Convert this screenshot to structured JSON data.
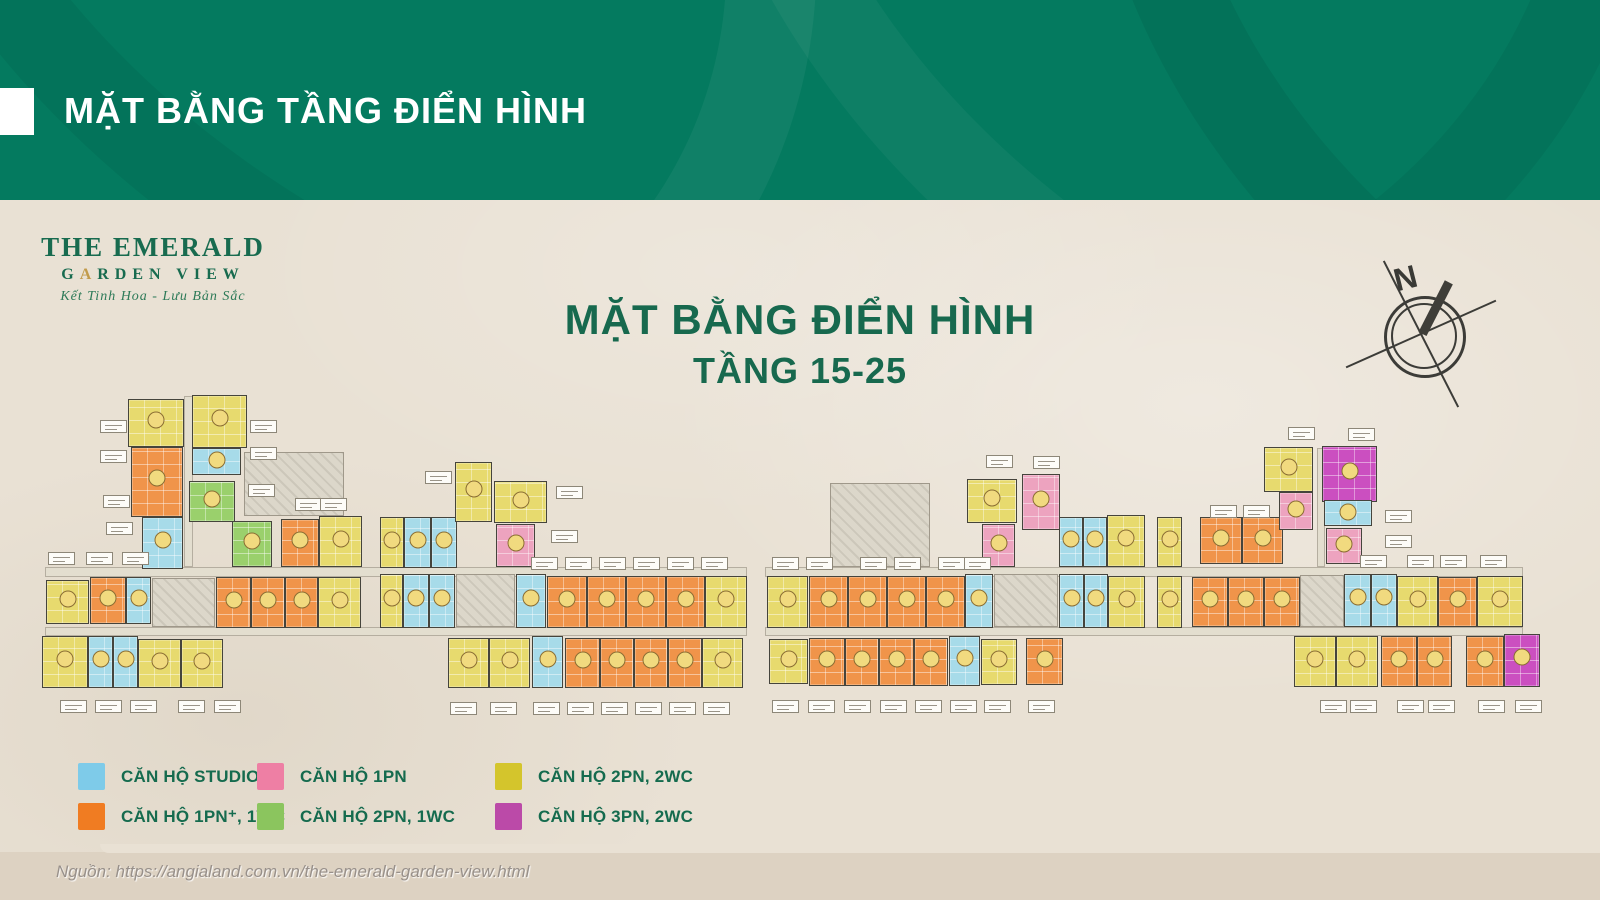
{
  "banner": {
    "title": "MẶT BẰNG TẦNG ĐIỂN HÌNH"
  },
  "logo": {
    "line1": "THE EMERALD",
    "garden_g": "G",
    "garden_a": "A",
    "garden_rest": "RDEN VIEW",
    "tagline": "Kết Tinh Hoa - Lưu Bản Sắc"
  },
  "heading": {
    "title": "MẶT BẰNG ĐIỂN HÌNH",
    "subtitle": "TẦNG 15-25"
  },
  "compass": {
    "label": "N"
  },
  "source": {
    "text": "Nguồn: https://angialand.com.vn/the-emerald-garden-view.html"
  },
  "legend": {
    "items": [
      {
        "type": "s",
        "label": "CĂN HỘ STUDIO"
      },
      {
        "type": "p",
        "label": "CĂN HỘ 1PN"
      },
      {
        "type": "y",
        "label": "CĂN HỘ 2PN, 2WC"
      },
      {
        "type": "o",
        "label": "CĂN HỘ 1PN⁺, 1WC"
      },
      {
        "type": "g",
        "label": "CĂN HỘ 2PN, 1WC"
      },
      {
        "type": "m",
        "label": "CĂN HỘ 3PN, 2WC"
      }
    ]
  },
  "colors": {
    "banner_green": "#047a5f",
    "title_green": "#17694e",
    "legend_swatches": {
      "s": "#7ecbe9",
      "p": "#ee7fa4",
      "y": "#d4c52c",
      "o": "#f07c22",
      "g": "#8bc55e",
      "m": "#bb4aa8"
    },
    "unit_types": {
      "s": "#a7dbe9",
      "p": "#eda3bf",
      "y": "#e7da6e",
      "o": "#f0944a",
      "g": "#9ad06c",
      "m": "#cb4fc0"
    },
    "type_names": {
      "s": "studio",
      "p": "1pn",
      "y": "2pn-2wc",
      "o": "1pn-plus-1wc",
      "g": "2pn-1wc",
      "m": "3pn-2wc"
    }
  },
  "floorplan": {
    "units": [
      [
        128,
        399,
        56,
        48,
        "y"
      ],
      [
        192,
        395,
        55,
        53,
        "y"
      ],
      [
        131,
        447,
        52,
        70,
        "o"
      ],
      [
        192,
        448,
        49,
        27,
        "s"
      ],
      [
        189,
        481,
        46,
        41,
        "g"
      ],
      [
        142,
        517,
        41,
        52,
        "s"
      ],
      [
        232,
        521,
        40,
        46,
        "g"
      ],
      [
        281,
        519,
        38,
        48,
        "o"
      ],
      [
        319,
        516,
        43,
        51,
        "y"
      ],
      [
        380,
        517,
        24,
        51,
        "y"
      ],
      [
        404,
        517,
        27,
        51,
        "s"
      ],
      [
        431,
        517,
        26,
        51,
        "s"
      ],
      [
        455,
        462,
        37,
        60,
        "y"
      ],
      [
        494,
        481,
        53,
        42,
        "y"
      ],
      [
        496,
        524,
        39,
        43,
        "p"
      ],
      [
        46,
        580,
        43,
        44,
        "y"
      ],
      [
        90,
        577,
        36,
        47,
        "o"
      ],
      [
        126,
        577,
        25,
        47,
        "s"
      ],
      [
        216,
        577,
        35,
        51,
        "o"
      ],
      [
        251,
        577,
        34,
        51,
        "o"
      ],
      [
        285,
        577,
        33,
        51,
        "o"
      ],
      [
        318,
        577,
        43,
        51,
        "y"
      ],
      [
        380,
        574,
        23,
        54,
        "y"
      ],
      [
        403,
        574,
        26,
        54,
        "s"
      ],
      [
        429,
        574,
        26,
        54,
        "s"
      ],
      [
        516,
        574,
        30,
        54,
        "s"
      ],
      [
        547,
        576,
        40,
        52,
        "o"
      ],
      [
        587,
        576,
        39,
        52,
        "o"
      ],
      [
        626,
        576,
        40,
        52,
        "o"
      ],
      [
        666,
        576,
        39,
        52,
        "o"
      ],
      [
        705,
        576,
        42,
        52,
        "y"
      ],
      [
        42,
        636,
        46,
        52,
        "y"
      ],
      [
        88,
        636,
        25,
        52,
        "s"
      ],
      [
        113,
        636,
        25,
        52,
        "s"
      ],
      [
        138,
        639,
        43,
        49,
        "y"
      ],
      [
        181,
        639,
        42,
        49,
        "y"
      ],
      [
        448,
        638,
        41,
        50,
        "y"
      ],
      [
        489,
        638,
        41,
        50,
        "y"
      ],
      [
        532,
        636,
        31,
        52,
        "s"
      ],
      [
        565,
        638,
        35,
        50,
        "o"
      ],
      [
        600,
        638,
        34,
        50,
        "o"
      ],
      [
        634,
        638,
        34,
        50,
        "o"
      ],
      [
        668,
        638,
        34,
        50,
        "o"
      ],
      [
        702,
        638,
        41,
        50,
        "y"
      ],
      [
        967,
        479,
        50,
        44,
        "y"
      ],
      [
        1022,
        474,
        38,
        56,
        "p"
      ],
      [
        982,
        524,
        33,
        43,
        "p"
      ],
      [
        1059,
        517,
        24,
        50,
        "s"
      ],
      [
        1083,
        517,
        24,
        50,
        "s"
      ],
      [
        1107,
        515,
        38,
        52,
        "y"
      ],
      [
        1157,
        517,
        25,
        50,
        "y"
      ],
      [
        767,
        576,
        41,
        52,
        "y"
      ],
      [
        809,
        576,
        39,
        52,
        "o"
      ],
      [
        848,
        576,
        39,
        52,
        "o"
      ],
      [
        887,
        576,
        39,
        52,
        "o"
      ],
      [
        926,
        576,
        39,
        52,
        "o"
      ],
      [
        965,
        574,
        28,
        54,
        "s"
      ],
      [
        1059,
        574,
        25,
        54,
        "s"
      ],
      [
        1084,
        574,
        24,
        54,
        "s"
      ],
      [
        1108,
        576,
        37,
        52,
        "y"
      ],
      [
        1157,
        576,
        25,
        52,
        "y"
      ],
      [
        1200,
        517,
        42,
        47,
        "o"
      ],
      [
        1242,
        517,
        41,
        47,
        "o"
      ],
      [
        1192,
        577,
        36,
        50,
        "o"
      ],
      [
        1228,
        577,
        36,
        50,
        "o"
      ],
      [
        1264,
        577,
        36,
        50,
        "o"
      ],
      [
        1344,
        574,
        27,
        53,
        "s"
      ],
      [
        1371,
        574,
        26,
        53,
        "s"
      ],
      [
        1397,
        576,
        41,
        51,
        "y"
      ],
      [
        1438,
        577,
        39,
        50,
        "o"
      ],
      [
        1477,
        576,
        46,
        51,
        "y"
      ],
      [
        1264,
        447,
        49,
        45,
        "y"
      ],
      [
        1322,
        446,
        55,
        56,
        "m"
      ],
      [
        1279,
        492,
        34,
        38,
        "p"
      ],
      [
        1324,
        500,
        48,
        26,
        "s"
      ],
      [
        1326,
        528,
        36,
        36,
        "p"
      ],
      [
        769,
        639,
        39,
        45,
        "y"
      ],
      [
        809,
        638,
        36,
        48,
        "o"
      ],
      [
        845,
        638,
        34,
        48,
        "o"
      ],
      [
        879,
        638,
        35,
        48,
        "o"
      ],
      [
        914,
        638,
        34,
        48,
        "o"
      ],
      [
        949,
        636,
        31,
        50,
        "s"
      ],
      [
        981,
        639,
        36,
        46,
        "y"
      ],
      [
        1026,
        638,
        37,
        47,
        "o"
      ],
      [
        1294,
        636,
        42,
        51,
        "y"
      ],
      [
        1336,
        636,
        42,
        51,
        "y"
      ],
      [
        1381,
        636,
        36,
        51,
        "o"
      ],
      [
        1417,
        636,
        35,
        51,
        "o"
      ],
      [
        1466,
        636,
        38,
        51,
        "o"
      ],
      [
        1504,
        634,
        36,
        53,
        "m"
      ]
    ],
    "corridors": [
      [
        45,
        567,
        702,
        10
      ],
      [
        765,
        567,
        758,
        10
      ],
      [
        45,
        627,
        702,
        9
      ],
      [
        765,
        627,
        758,
        9
      ],
      [
        184,
        396,
        9,
        171
      ],
      [
        1317,
        448,
        8,
        119
      ]
    ],
    "cores": [
      [
        152,
        578,
        63,
        49
      ],
      [
        456,
        574,
        59,
        53
      ],
      [
        994,
        574,
        64,
        53
      ],
      [
        1300,
        575,
        44,
        52
      ],
      [
        830,
        483,
        100,
        84
      ],
      [
        244,
        452,
        100,
        64
      ]
    ],
    "labels": [
      [
        100,
        420
      ],
      [
        100,
        450
      ],
      [
        103,
        495
      ],
      [
        106,
        522
      ],
      [
        48,
        552
      ],
      [
        86,
        552
      ],
      [
        122,
        552
      ],
      [
        250,
        420
      ],
      [
        250,
        447
      ],
      [
        248,
        484
      ],
      [
        295,
        498
      ],
      [
        320,
        498
      ],
      [
        425,
        471
      ],
      [
        556,
        486
      ],
      [
        551,
        530
      ],
      [
        531,
        557
      ],
      [
        565,
        557
      ],
      [
        599,
        557
      ],
      [
        633,
        557
      ],
      [
        667,
        557
      ],
      [
        701,
        557
      ],
      [
        60,
        700
      ],
      [
        95,
        700
      ],
      [
        130,
        700
      ],
      [
        178,
        700
      ],
      [
        214,
        700
      ],
      [
        450,
        702
      ],
      [
        490,
        702
      ],
      [
        533,
        702
      ],
      [
        567,
        702
      ],
      [
        601,
        702
      ],
      [
        635,
        702
      ],
      [
        669,
        702
      ],
      [
        703,
        702
      ],
      [
        986,
        455
      ],
      [
        1033,
        456
      ],
      [
        772,
        557
      ],
      [
        806,
        557
      ],
      [
        860,
        557
      ],
      [
        894,
        557
      ],
      [
        938,
        557
      ],
      [
        964,
        557
      ],
      [
        772,
        700
      ],
      [
        808,
        700
      ],
      [
        844,
        700
      ],
      [
        880,
        700
      ],
      [
        915,
        700
      ],
      [
        950,
        700
      ],
      [
        984,
        700
      ],
      [
        1028,
        700
      ],
      [
        1288,
        427
      ],
      [
        1348,
        428
      ],
      [
        1210,
        505
      ],
      [
        1243,
        505
      ],
      [
        1385,
        510
      ],
      [
        1385,
        535
      ],
      [
        1360,
        555
      ],
      [
        1407,
        555
      ],
      [
        1440,
        555
      ],
      [
        1480,
        555
      ],
      [
        1320,
        700
      ],
      [
        1350,
        700
      ],
      [
        1397,
        700
      ],
      [
        1428,
        700
      ],
      [
        1478,
        700
      ],
      [
        1515,
        700
      ]
    ]
  }
}
